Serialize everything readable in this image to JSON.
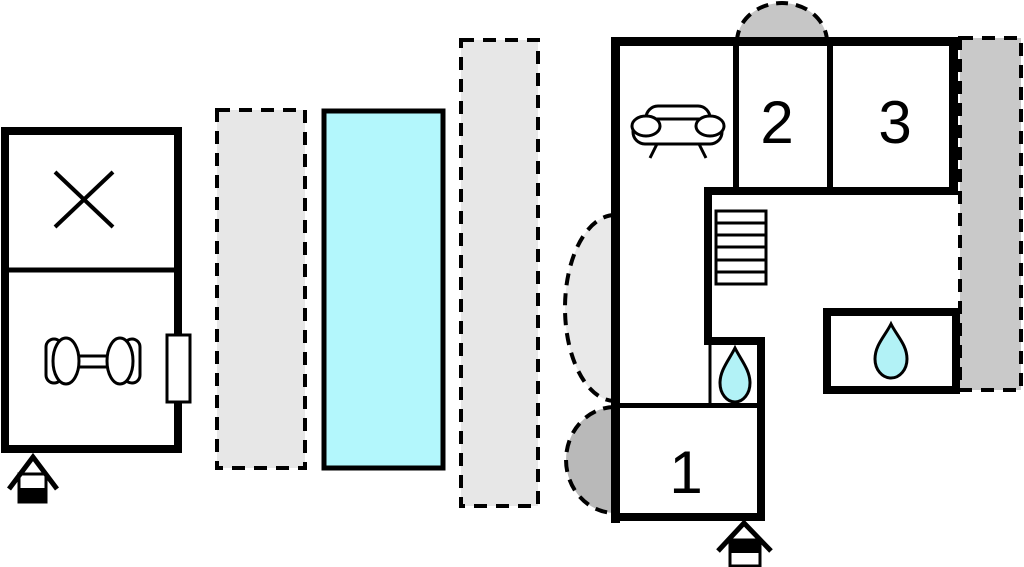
{
  "title": "holiday-home-floor-plan",
  "colors": {
    "background": "#ffffff",
    "wall": "#000000",
    "room-fill": "#ffffff",
    "pool": "#b3f7fc",
    "water-drop": "#b2f2f6",
    "terrace-light": "#e7e7e7",
    "terrace-right": "#c9c9c9",
    "semi-top": "#c6c6c6",
    "semi-upper-left": "#e9e9e9",
    "semi-lower-left": "#b9b9b9"
  },
  "rooms": {
    "bedroom1": {
      "label": "1"
    },
    "bedroom2": {
      "label": "2"
    },
    "bedroom3": {
      "label": "3"
    },
    "living_area": {
      "icon": "sofa-icon"
    },
    "gym_room": {
      "icon": "dumbbell-icon"
    },
    "crossed_room": {
      "icon": "crossed-lines-icon"
    },
    "bathroom_inner": {
      "icon": "water-drop-icon"
    },
    "bathroom_annex": {
      "icon": "water-drop-icon"
    },
    "stair_hall": {
      "icon": "stairs-icon"
    }
  },
  "outdoor": {
    "pool": "swimming-pool",
    "terrace_left_1": "dashed-terrace",
    "terrace_left_2": "dashed-terrace",
    "terrace_right": "dashed-terrace",
    "semicircle_top": "dashed-semicircle",
    "semicircle_upper_left": "dashed-semicircle",
    "semicircle_lower_left": "dashed-semicircle"
  },
  "markers": {
    "entrance_left": "house-entrance-icon",
    "entrance_main": "house-entrance-icon",
    "door_left_building": "door"
  }
}
